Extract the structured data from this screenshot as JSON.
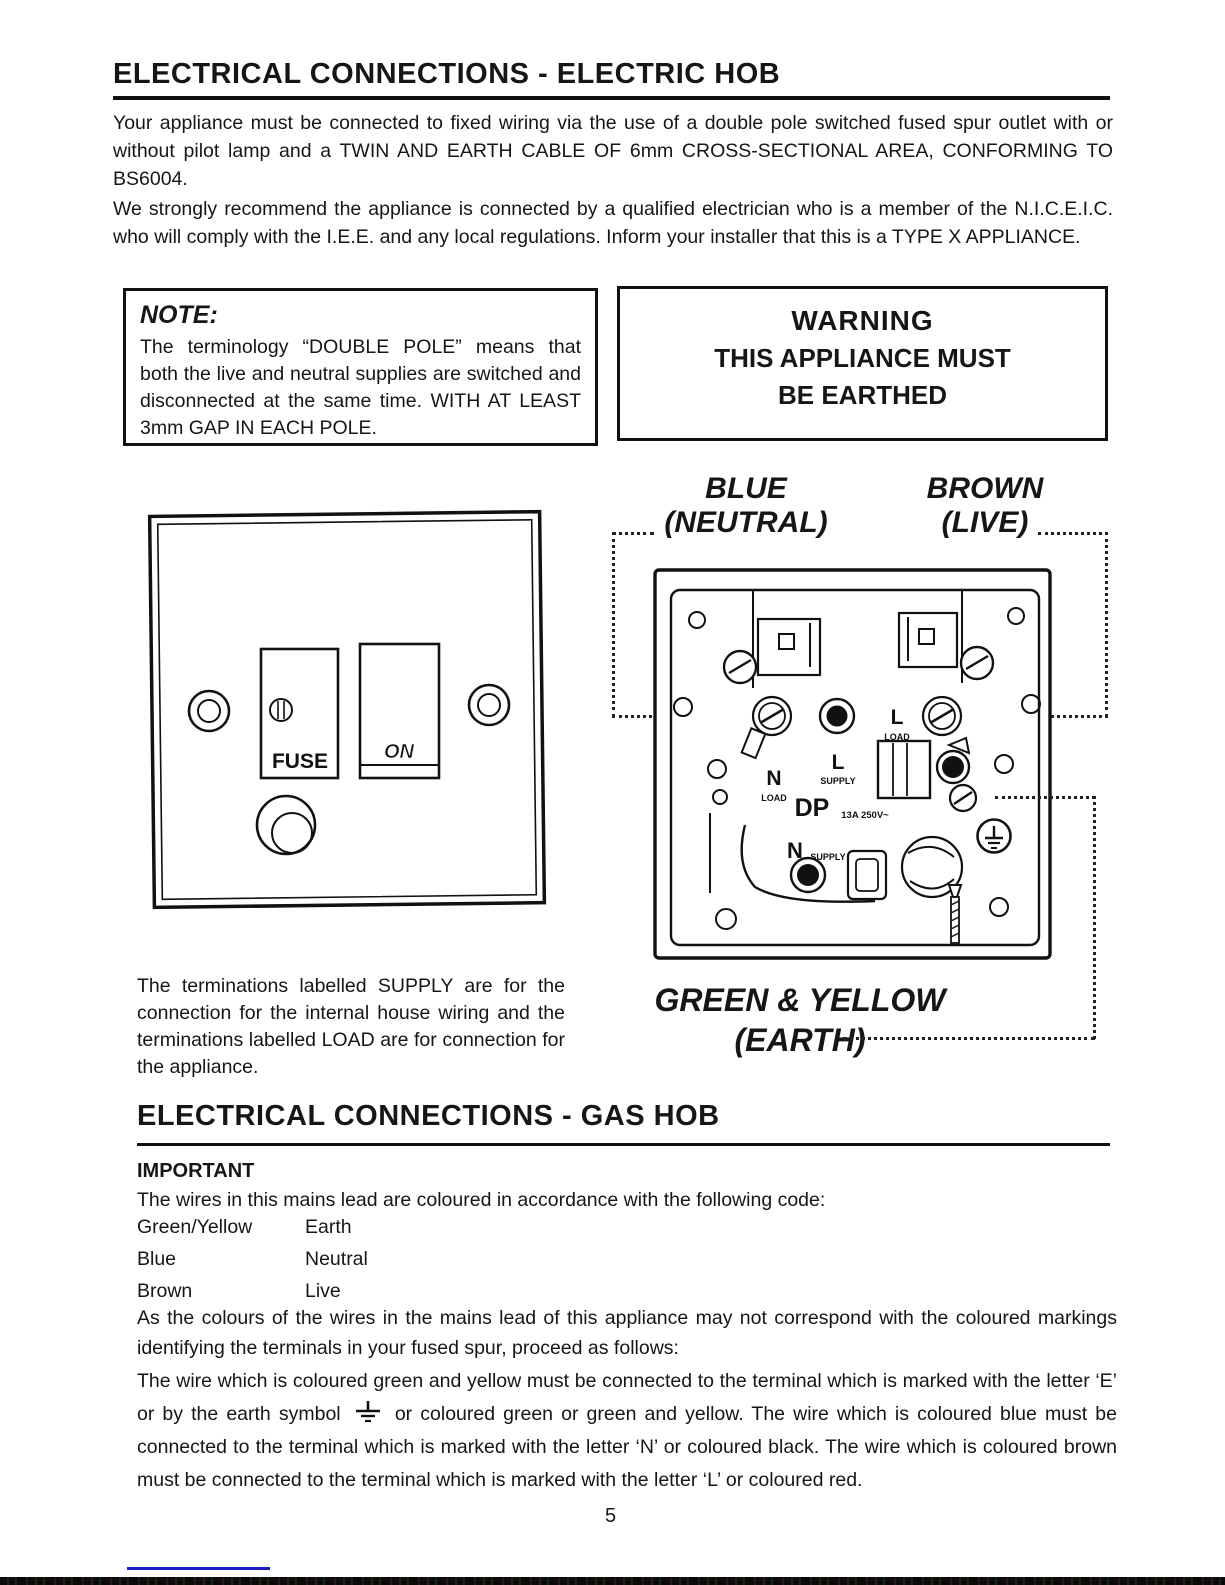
{
  "page": {
    "number": "5"
  },
  "electric": {
    "title": "ELECTRICAL CONNECTIONS - ELECTRIC HOB",
    "para1": "Your appliance must be connected to fixed wiring via the use of a double pole switched fused spur outlet with or without pilot lamp and a TWIN AND EARTH CABLE OF 6mm CROSS-SECTIONAL AREA, CONFORMING TO BS6004.",
    "para2": "We strongly recommend the appliance is connected by a qualified electrician who is a member of the N.I.C.E.I.C. who will comply with the I.E.E. and any local regulations. Inform your installer that this is a TYPE X APPLIANCE.",
    "note": {
      "heading": "NOTE:",
      "body": "The terminology “DOUBLE POLE” means that both the live and neutral supplies are switched and disconnected at the same time. WITH AT LEAST 3mm GAP IN EACH POLE."
    },
    "warning": {
      "line1": "WARNING",
      "line2": "THIS APPLIANCE MUST",
      "line3": "BE EARTHED"
    },
    "labels": {
      "neutral_1": "BLUE",
      "neutral_2": "(NEUTRAL)",
      "live_1": "BROWN",
      "live_2": "(LIVE)",
      "earth_1": "GREEN & YELLOW",
      "earth_2": "(EARTH)"
    },
    "caption": "The terminations labelled SUPPLY are for the connection for the internal house wiring and the terminations labelled LOAD are for connection for the appliance.",
    "spur_front": {
      "fuse": "FUSE",
      "on": "ON"
    },
    "spur_back": {
      "l_load": "L",
      "l_load_sub": "LOAD",
      "l_supply": "L",
      "l_supply_sub": "SUPPLY",
      "n_load": "N",
      "n_load_sub": "LOAD",
      "n_supply": "N",
      "n_supply_sub": "SUPPLY",
      "dp": "DP",
      "dp_rating": "13A 250V~"
    }
  },
  "gas": {
    "title": "ELECTRICAL CONNECTIONS - GAS HOB",
    "important": "IMPORTANT",
    "intro": "The wires in this mains lead are coloured in accordance with the following code:",
    "wire_table": [
      {
        "colour": "Green/Yellow",
        "function": "Earth"
      },
      {
        "colour": "Blue",
        "function": "Neutral"
      },
      {
        "colour": "Brown",
        "function": "Live"
      }
    ],
    "para1": "As the colours of the wires in the mains lead of this appliance may not correspond with the coloured markings identifying the terminals in your fused spur, proceed as follows:",
    "para2_before": "The wire which is coloured green and yellow must be connected to the terminal which is marked with the letter ‘E’ or by the earth symbol",
    "para2_after": "or coloured green or green and yellow. The wire which is coloured blue must be connected to the terminal which is marked with the letter ‘N’ or coloured black. The wire which is coloured brown must be connected to the terminal which is marked with the letter ‘L’ or coloured red."
  },
  "colors": {
    "ink": "#161616",
    "footer_blue": "#1d1dc4"
  }
}
